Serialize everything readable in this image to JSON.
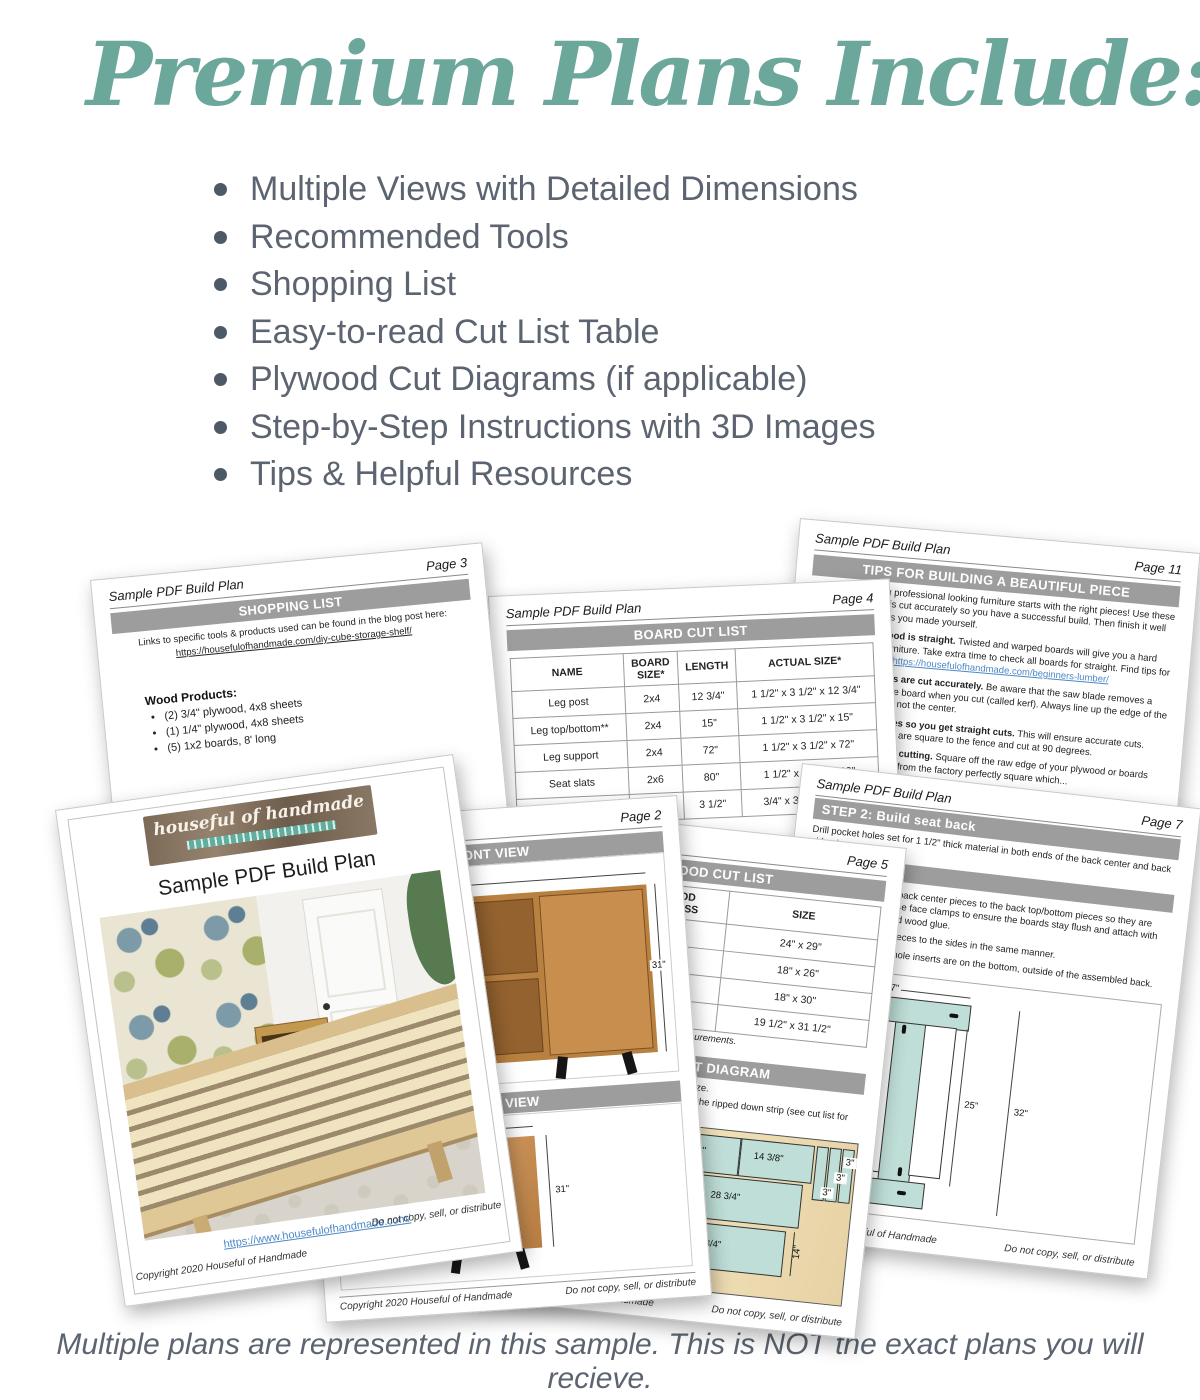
{
  "heading": {
    "title": "Premium Plans Include:"
  },
  "features": [
    "Multiple Views with Detailed Dimensions",
    "Recommended Tools",
    "Shopping List",
    "Easy-to-read Cut List Table",
    "Plywood Cut Diagrams (if applicable)",
    "Step-by-Step Instructions with 3D Images",
    "Tips & Helpful Resources"
  ],
  "footnote": "Multiple plans are represented in this sample. This is NOT the exact plans you will recieve.",
  "common": {
    "doc_title": "Sample PDF Build Plan",
    "copyright": "Copyright 2020 Houseful of Handmade",
    "do_not_copy": "Do not copy, sell, or distribute"
  },
  "cover": {
    "logo": "houseful of handmade",
    "title": "Sample PDF Build Plan",
    "url": "https://www.housefulofhandmade.com/"
  },
  "shopping": {
    "page": "Page 3",
    "header": "SHOPPING LIST",
    "intro": "Links to specific tools & products used can be found in the blog post here:",
    "url": "https://housefulofhandmade.com/diy-cube-storage-shelf/",
    "section": "Wood Products:",
    "items": [
      "(2) 3/4\" plywood, 4x8 sheets",
      "(1) 1/4\" plywood, 4x8 sheets",
      "(5) 1x2 boards, 8' long"
    ]
  },
  "board_cut": {
    "page": "Page 4",
    "header": "BOARD CUT LIST",
    "columns": [
      "NAME",
      "BOARD SIZE*",
      "LENGTH",
      "ACTUAL SIZE*"
    ],
    "rows": [
      [
        "Leg post",
        "2x4",
        "12 3/4\"",
        "1 1/2\" x 3 1/2\" x 12 3/4\""
      ],
      [
        "Leg top/bottom**",
        "2x4",
        "15\"",
        "1 1/2\" x 3 1/2\" x 15\""
      ],
      [
        "Leg support",
        "2x4",
        "72\"",
        "1 1/2\" x 3 1/2\" x 72\""
      ],
      [
        "Seat slats",
        "2x6",
        "80\"",
        "1 1/2\" x 5 1/2\" x 80\""
      ],
      [
        "",
        "1x4",
        "3 1/2\"",
        "3/4\" x 3 1/2\" x 3 1/2\""
      ]
    ],
    "note": "*dimensional"
  },
  "tips": {
    "page": "Page 11",
    "header": "TIPS FOR BUILDING A BEAUTIFUL PIECE",
    "intro": "The key to building professional looking furniture starts with the right pieces! Use these tips so each piece is cut accurately so you have a successful build. Then finish it well so no one will guess you made yourself.",
    "items": [
      {
        "lead": "Make sure your wood is straight.",
        "text": "Twisted and warped boards will give you a hard time and crooked furniture. Take extra time to check all boards for straight. Find tips for buying lumber here: ",
        "link": "https://housefulofhandmade.com/beginners-lumber/"
      },
      {
        "lead": "Make sure all boards are cut accurately.",
        "text": "Be aware that the saw blade removes a sliver of wood from the board when you cut (called kerf). Always line up the edge of the blade up with the line, not the center.",
        "link": ""
      },
      {
        "lead": "Square up your blades so you get straight cuts.",
        "text": "This will ensure accurate cuts. Make sure your blades are square to the fence and cut at 90 degrees.",
        "link": ""
      },
      {
        "lead": "Square boards before cutting.",
        "text": "Square off the raw edge of your plywood or boards since they do not come from the factory perfectly square which...",
        "link": ""
      }
    ]
  },
  "step2": {
    "page": "Page 7",
    "header": "STEP 2: Build seat back",
    "p1": "Drill pocket holes set for 1 1/2\" thick material in both ends of the back center and back side pieces.",
    "p2": "Start by attaching the back center pieces to the back top/bottom pieces so they are flush with the sides. Use face clamps to ensure the boards stay flush and attach with pocket hole screws and wood glue.",
    "p3": "Attach the back side pieces to the sides in the same manner.",
    "p4": "Make sure the pocket hole inserts are on the bottom, outside of the assembled back.",
    "dims": {
      "top": "17\"",
      "left": "4 1/4\"",
      "mid": "25\"",
      "right": "32\""
    }
  },
  "plywood": {
    "page": "Page 5",
    "header": "PLYWOOD CUT LIST",
    "columns": [
      "",
      "PLYWOOD THICKNESS",
      "SIZE"
    ],
    "rows": [
      [
        "",
        "1/2\"",
        "24\" x 29\""
      ],
      [
        "",
        "1/2\"",
        "18\" x 26\""
      ],
      [
        "",
        "1/2\"",
        "18\" x 30\""
      ],
      [
        "",
        "1/2\"",
        "19 1/2\" x 31 1/2\""
      ]
    ],
    "note": "See next page for window and door measurements.",
    "diagram_header": "PLYWOOD CUT DIAGRAM",
    "note1": "Rip strips first, then cross-cut the pieces to size.",
    "note2": "Pieces will need to be cut down smaller from the ripped down strip (see cut list for exact measurements).",
    "dims": {
      "r1": [
        "14\"",
        "14 3/8\"",
        "14 3/8\"",
        "14 3/8\""
      ],
      "strips": [
        "3\"",
        "3\"",
        "3\""
      ],
      "r2": [
        "28 3/4\"",
        "28 3/4\""
      ],
      "r3": [
        "30 1/4\"",
        "28 3/4\""
      ],
      "side": "14\""
    }
  },
  "views": {
    "page": "Page 2",
    "front_header": "FRONT VIEW",
    "side_header": "SIDE VIEW",
    "front_w": "45 1/4\"",
    "front_h": "31\"",
    "side_w": "15\"",
    "side_h": "31\""
  }
}
